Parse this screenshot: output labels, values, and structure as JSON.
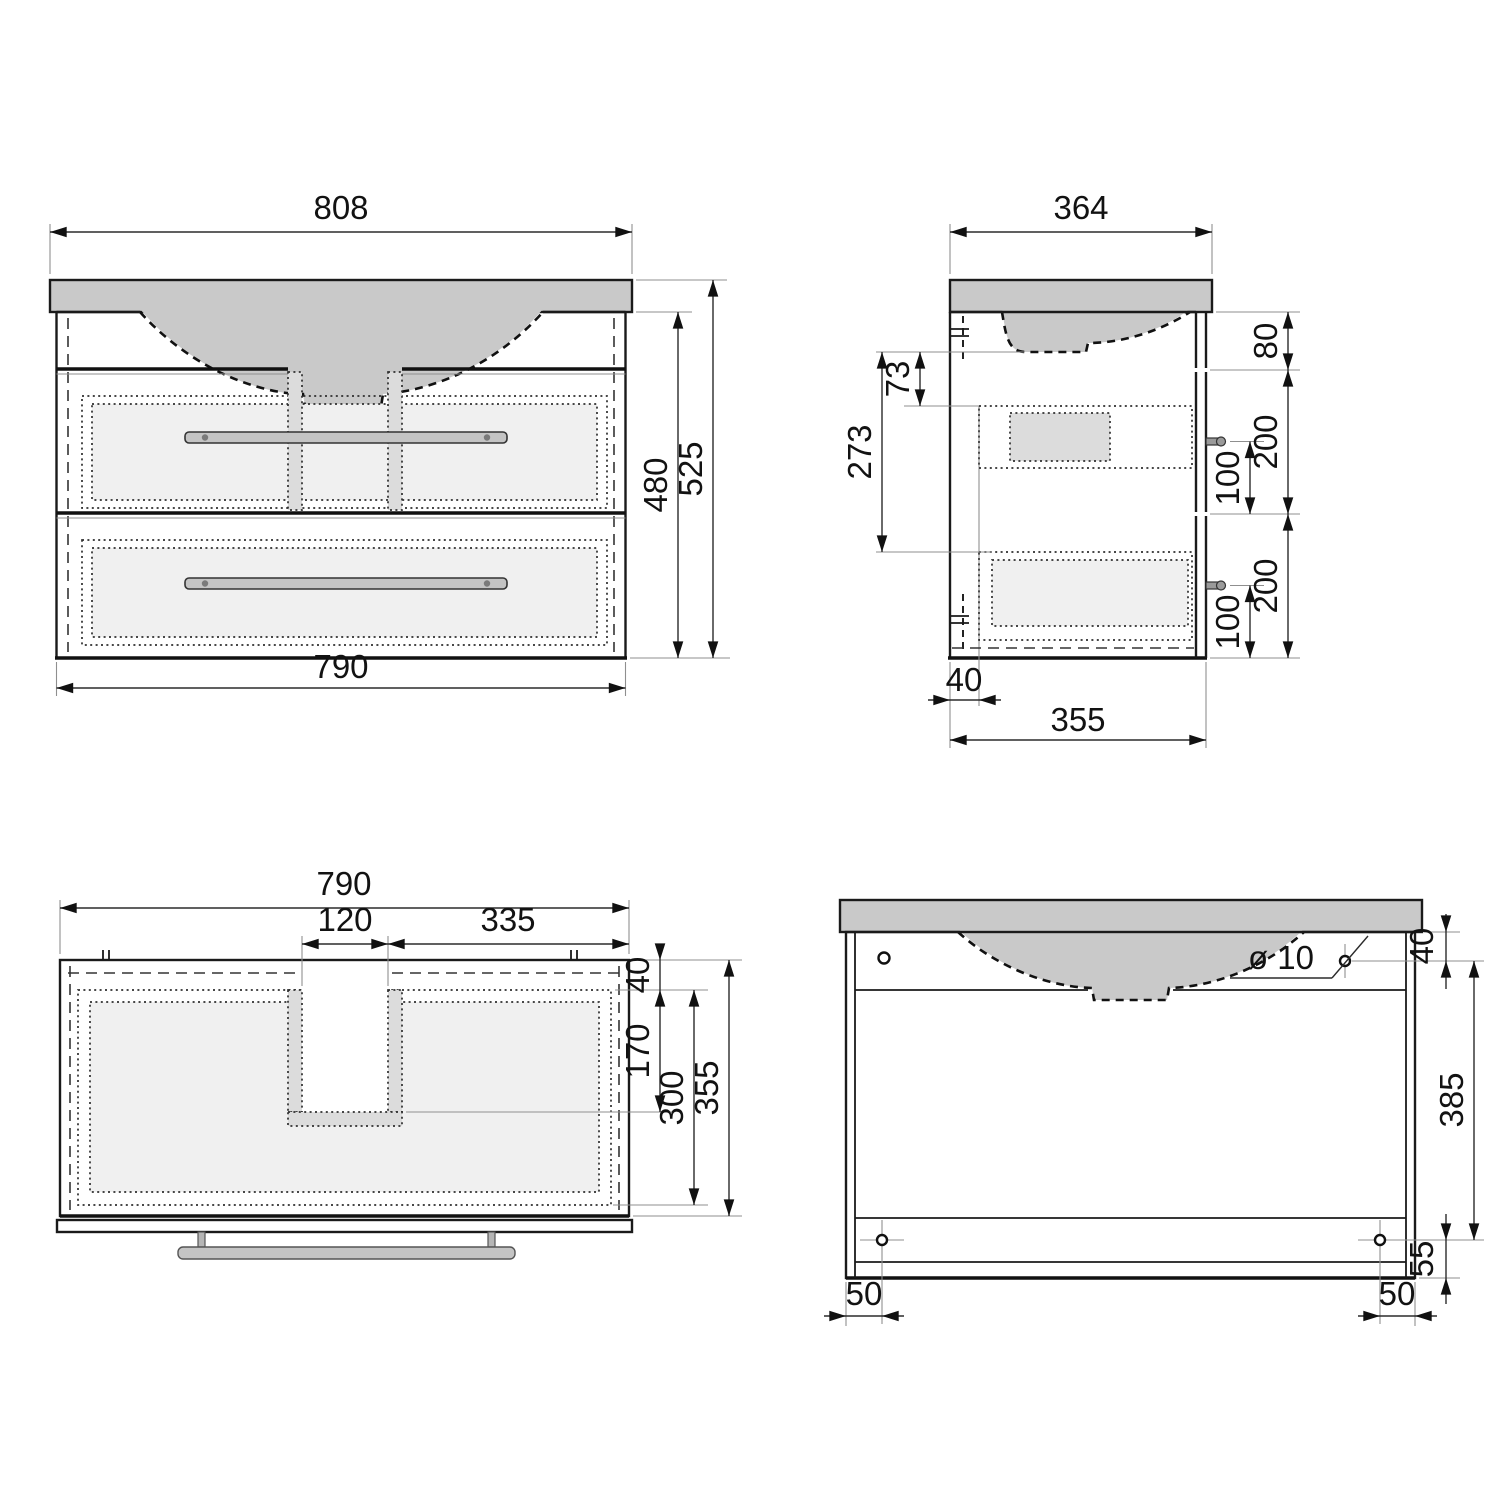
{
  "drawing": {
    "colors": {
      "line": "#1a1a1a",
      "surface_gray": "#c9c9c9",
      "drawer_light": "#f0f0f0",
      "strip_gray": "#dcdcdc"
    },
    "views": {
      "front": {
        "dims": {
          "top_width": "808",
          "bottom_width": "790",
          "body_height": "480",
          "total_height": "525"
        }
      },
      "side": {
        "dims": {
          "top_depth": "364",
          "body_depth": "355",
          "top_section_height": "80",
          "upper_drawer_height": "200",
          "upper_handle_offset": "100",
          "lower_drawer_height": "200",
          "lower_handle_offset": "100",
          "basin_clearance": "73",
          "inner_depth": "273",
          "back_clearance": "40"
        }
      },
      "top": {
        "dims": {
          "width": "790",
          "cutout_width": "120",
          "right_section_width": "335",
          "back_offset": "40",
          "cutout_depth": "170",
          "drawer_inner_depth": "300",
          "total_depth": "355"
        }
      },
      "back": {
        "dims": {
          "hole_diameter": "ø 10",
          "hole_top_offset": "40",
          "mount_hole_spacing": "385",
          "hole_bottom_offset": "55",
          "hole_left_inset": "50",
          "hole_right_inset": "50"
        }
      }
    }
  }
}
